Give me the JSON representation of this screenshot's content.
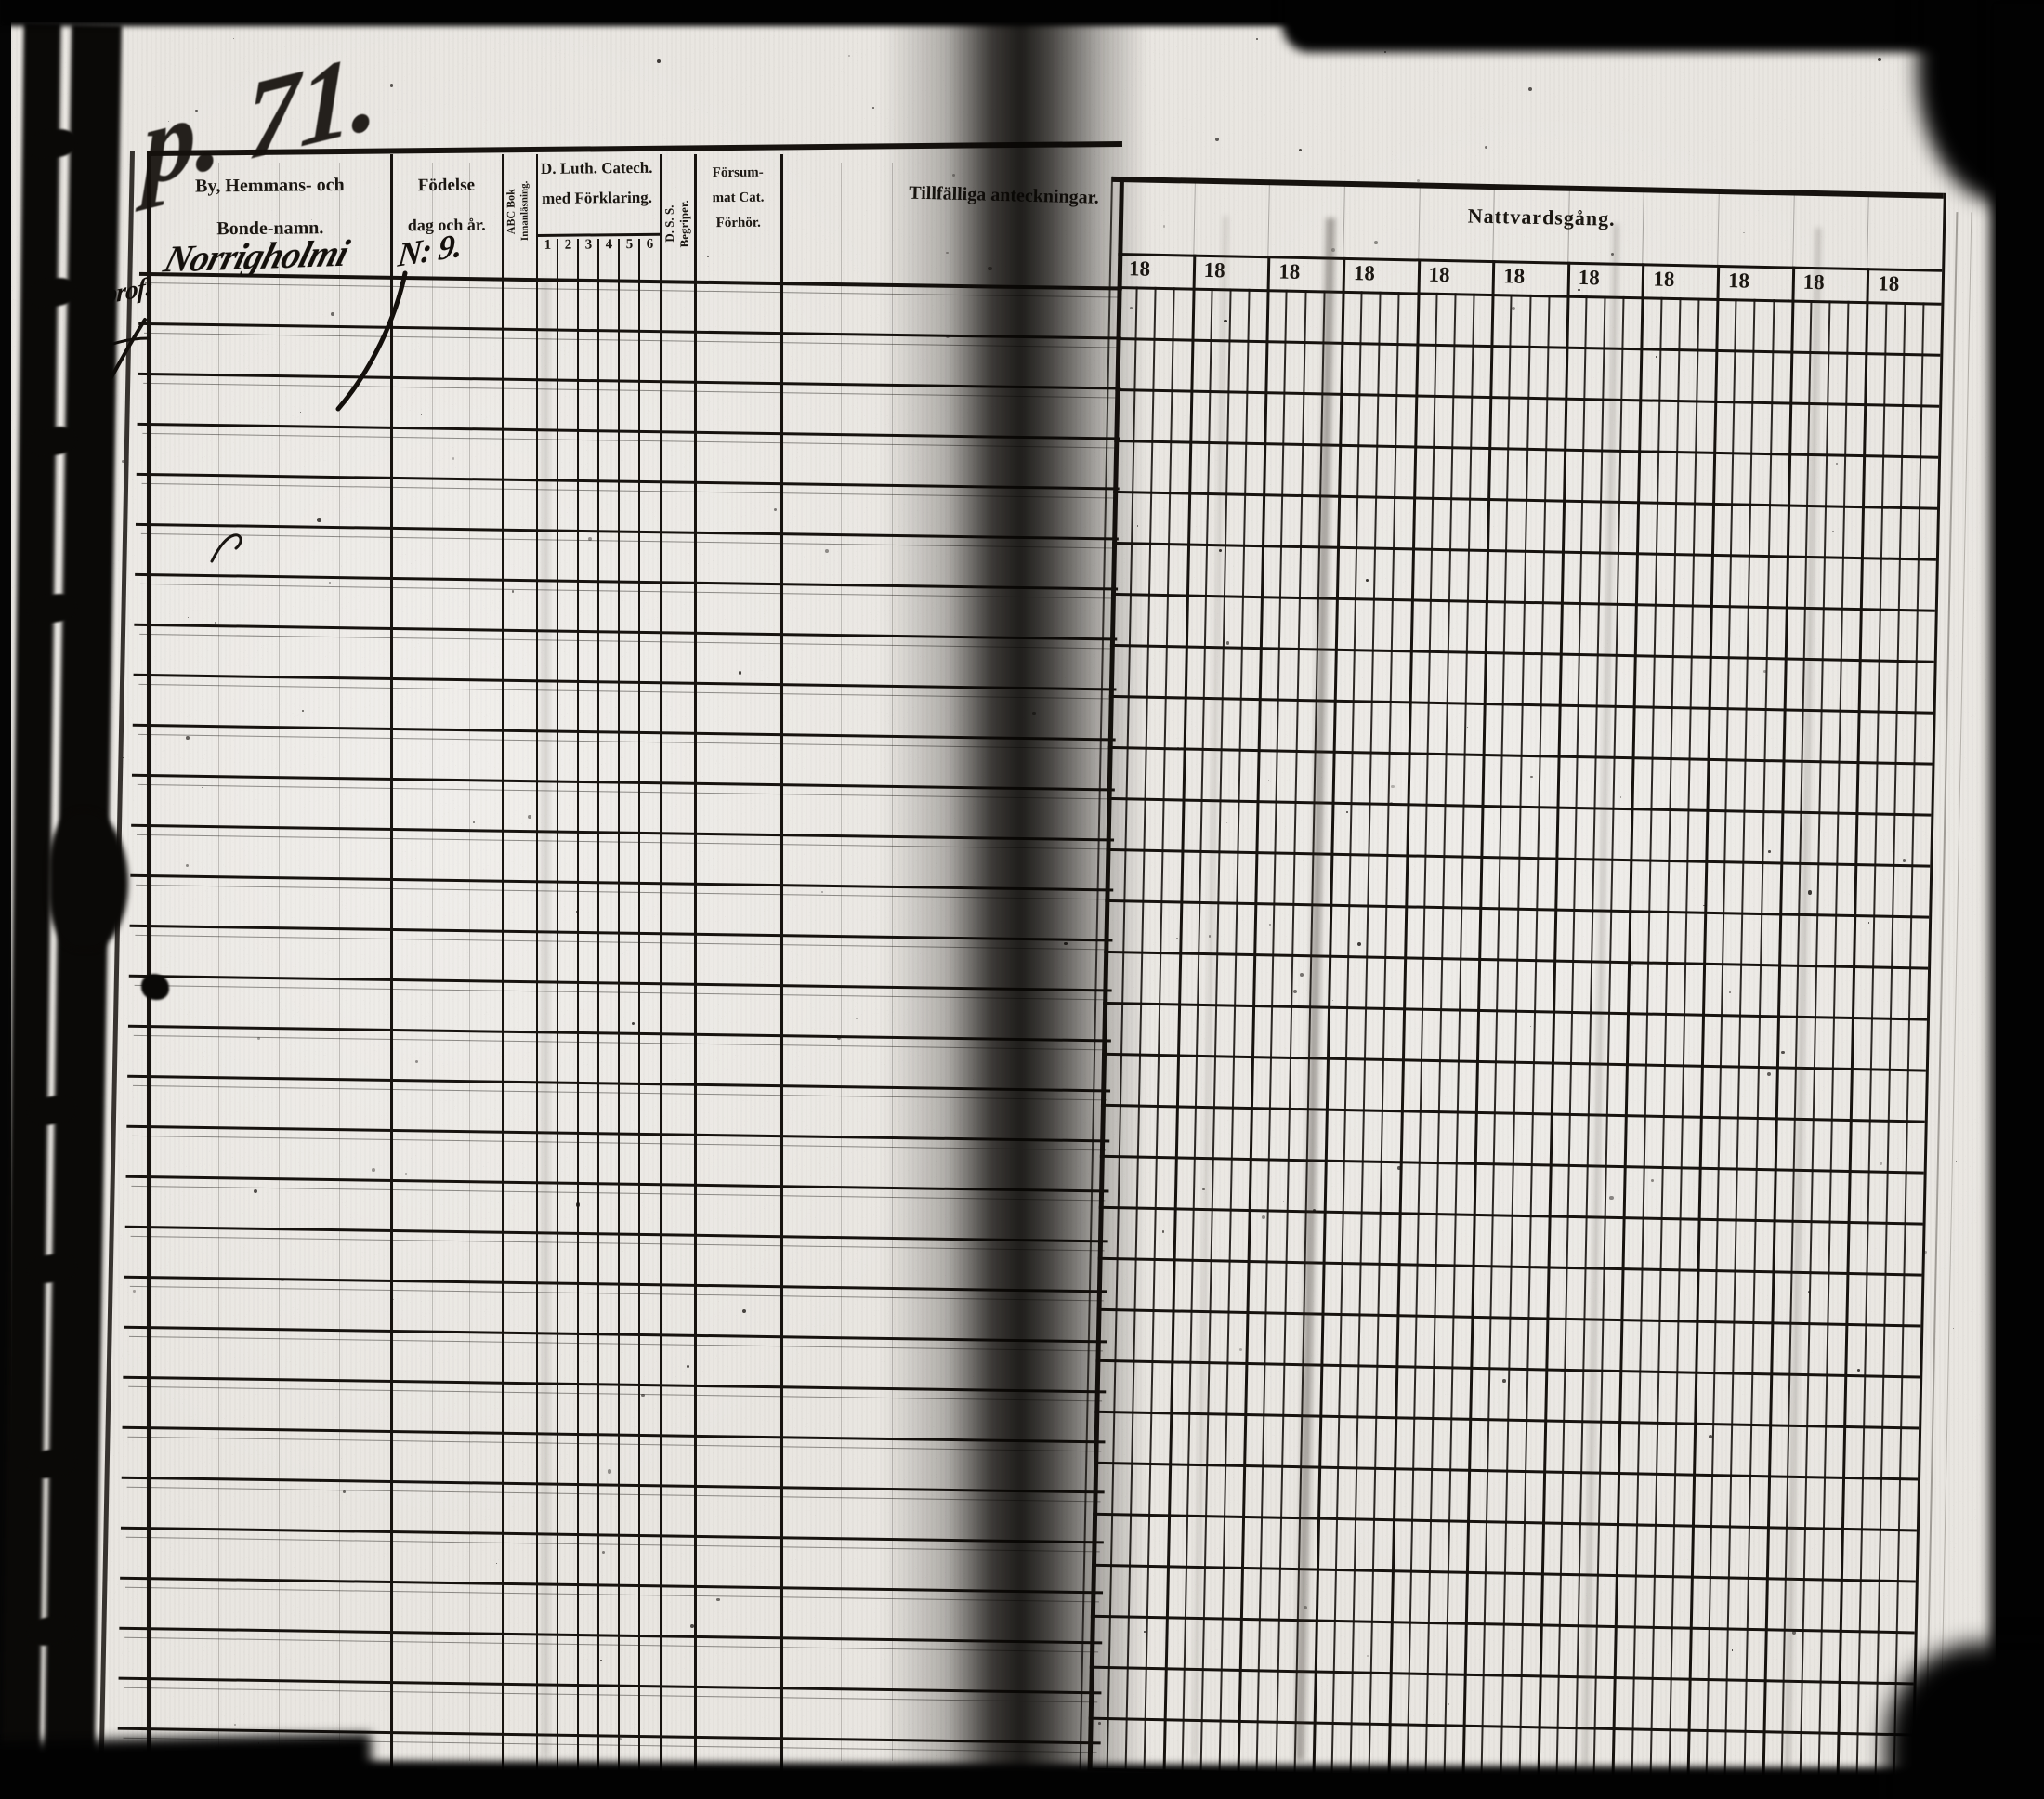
{
  "handwriting": {
    "page_number": "p. 71.",
    "village_name": "Norrigholmi",
    "birth_note": "N: 9.",
    "margin_note": "prof:"
  },
  "left_table": {
    "col_name_line1": "By, Hemmans- och",
    "col_name_line2": "Bonde-namn.",
    "col_birth_line1": "Födelse",
    "col_birth_line2": "dag och år.",
    "col_abc_line1": "ABC Bok",
    "col_abc_line2": "Innanläsning.",
    "col_cat_line1": "D. Luth. Catech.",
    "col_cat_line2": "med Förklaring.",
    "cat_subcols": [
      "1",
      "2",
      "3",
      "4",
      "5",
      "6"
    ],
    "col_begriper_line1": "D. S. S.",
    "col_begriper_line2": "Begriper.",
    "col_missed_line1": "Försum-",
    "col_missed_line2": "mat Cat.",
    "col_missed_line3": "Förhör.",
    "col_notes": "Tillfälliga anteckningar.",
    "body_rows": 31
  },
  "right_table": {
    "title": "Nattvardsgång.",
    "year_label": "18",
    "year_columns": 11,
    "subcells_per_year": 4,
    "body_rows": 30
  },
  "colors": {
    "paper": "#e9e6e1",
    "ink": "#17130f"
  }
}
